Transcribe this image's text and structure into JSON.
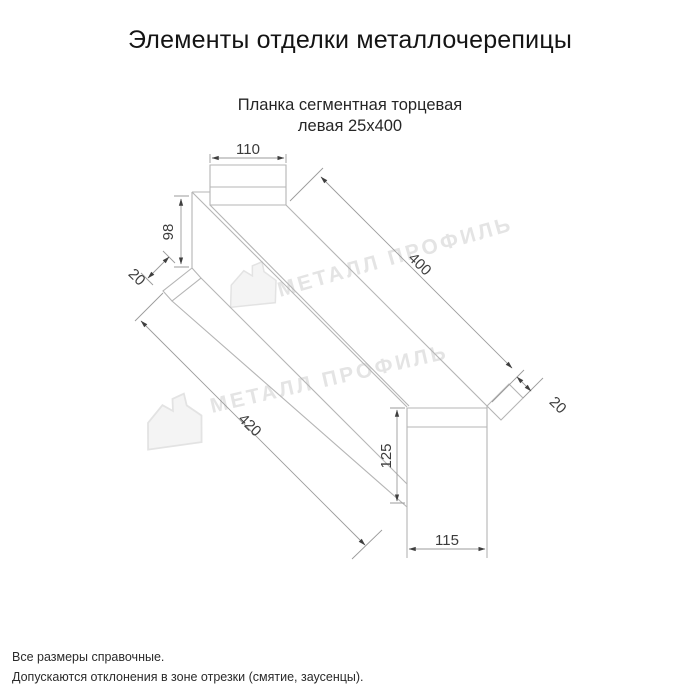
{
  "header": {
    "title": "Элементы отделки металлочерепицы"
  },
  "part": {
    "name_line1": "Планка сегментная торцевая",
    "name_line2": "левая 25х400"
  },
  "dimensions": {
    "top_flange_width": "110",
    "left_end_height": "98",
    "left_end_fold": "20",
    "top_edge_length": "400",
    "bottom_edge_length": "420",
    "right_end_fold": "20",
    "end_view_height": "125",
    "end_view_width": "115"
  },
  "watermark": {
    "text": "МЕТАЛЛ ПРОФИЛЬ",
    "color": "#e4e4e4"
  },
  "notes": {
    "line1": "Все размеры справочные.",
    "line2": "Допускаются отклонения в зоне отрезки (смятие, заусенцы)."
  },
  "colors": {
    "outline": "#b5b5b5",
    "dimension_line": "#9b9b9b",
    "dimension_text": "#3c3c3c",
    "title_text": "#141414"
  }
}
